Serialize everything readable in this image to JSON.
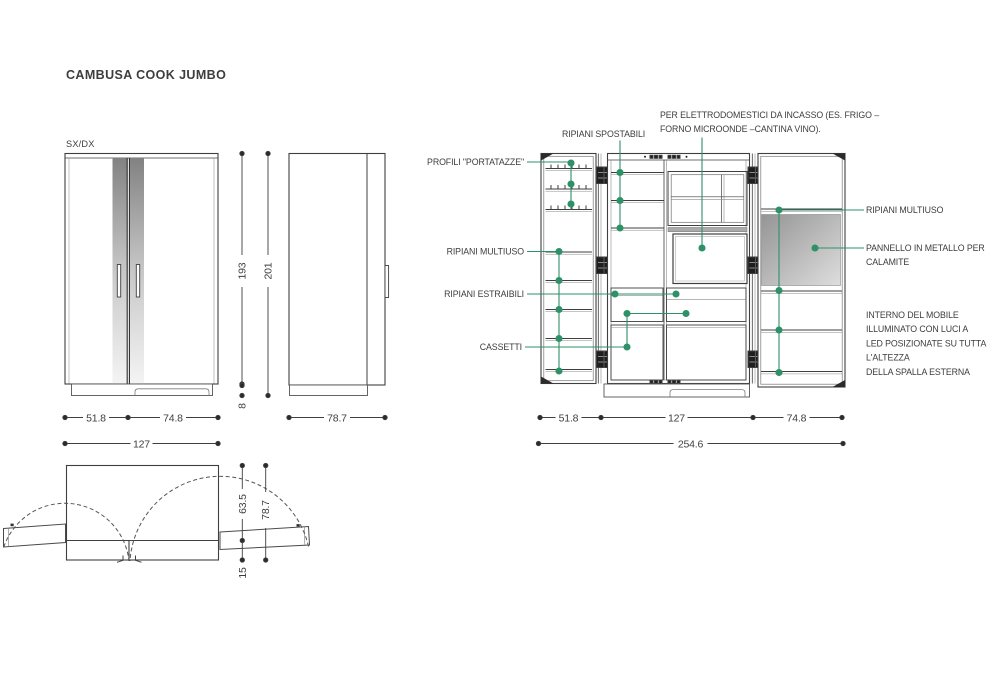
{
  "title": "CAMBUSA COOK JUMBO",
  "variant_label": "SX/DX",
  "colors": {
    "accent_green": "#2f9168",
    "line": "#3f3f3f"
  },
  "front_view": {
    "dim_left_door": "51.8",
    "dim_right_door": "74.8",
    "dim_total_width": "127",
    "dim_body_height": "193",
    "dim_total_height": "201",
    "dim_plinth_height": "8"
  },
  "side_view": {
    "dim_depth": "78.7"
  },
  "plan_view": {
    "dim_body_depth": "63.5",
    "dim_total_depth": "78.7",
    "dim_door_depth": "15"
  },
  "open_view": {
    "labels": {
      "profili_portatazze": "PROFILI \"PORTATAZZE\"",
      "ripiani_spostabili": "RIPIANI SPOSTABILI",
      "per_elettrodomestici_1": "PER ELETTRODOMESTICI DA INCASSO (ES. FRIGO –",
      "per_elettrodomestici_2": "FORNO MICROONDE –CANTINA VINO).",
      "ripiani_multiuso_left": "RIPIANI MULTIUSO",
      "ripiani_estraibili": "RIPIANI ESTRAIBILI",
      "cassetti": "CASSETTI",
      "ripiani_multiuso_right": "RIPIANI MULTIUSO",
      "pannello_metallo_1": "PANNELLO IN METALLO PER",
      "pannello_metallo_2": "CALAMITE",
      "interno_1": "INTERNO DEL MOBILE",
      "interno_2": "ILLUMINATO CON LUCI A",
      "interno_3": "LED POSIZIONATE SU TUTTA",
      "interno_4": "L'ALTEZZA",
      "interno_5": "DELLA SPALLA ESTERNA"
    },
    "dims": {
      "left_door": "51.8",
      "center_body": "127",
      "right_door": "74.8",
      "total_width": "254.6"
    }
  }
}
